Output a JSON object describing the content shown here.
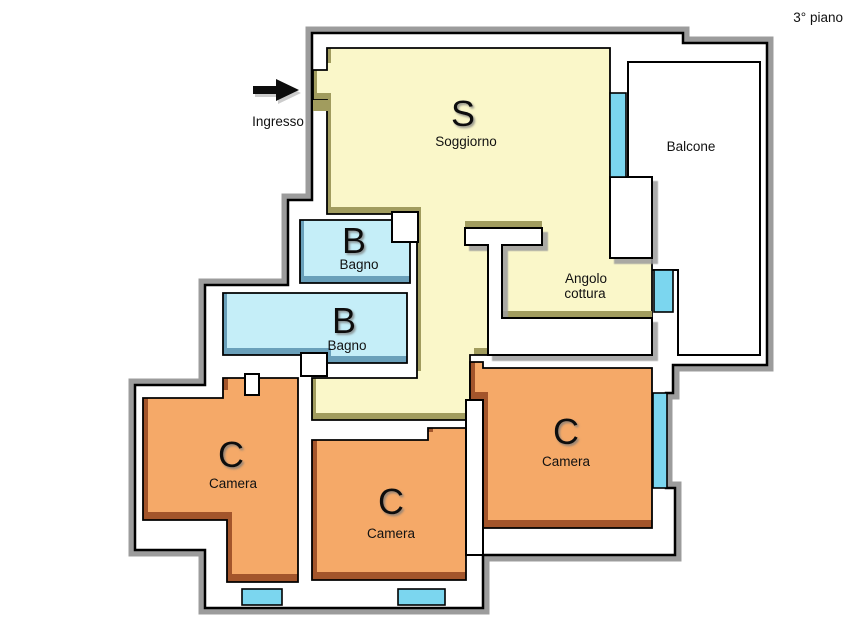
{
  "floor_label": "3° piano",
  "entrance": {
    "label": "Ingresso"
  },
  "rooms": {
    "soggiorno": {
      "letter": "S",
      "name": "Soggiorno"
    },
    "balcone": {
      "name": "Balcone"
    },
    "angolo_cottura": {
      "line1": "Angolo",
      "line2": "cottura"
    },
    "bagno_1": {
      "letter": "B",
      "name": "Bagno"
    },
    "bagno_2": {
      "letter": "B",
      "name": "Bagno"
    },
    "camera_1": {
      "letter": "C",
      "name": "Camera"
    },
    "camera_2": {
      "letter": "C",
      "name": "Camera"
    },
    "camera_3": {
      "letter": "C",
      "name": "Camera"
    }
  },
  "colors": {
    "living": "#FAF7C9",
    "living_shade": "#A19C5E",
    "bath": "#C5EEF8",
    "bath_shade": "#6AA0BA",
    "bedroom": "#F5A968",
    "bedroom_shade": "#A3552B",
    "window": "#7BD6EF",
    "wall": "#FFFFFF",
    "outline": "#000000",
    "shadow": "#9C9C9C"
  }
}
